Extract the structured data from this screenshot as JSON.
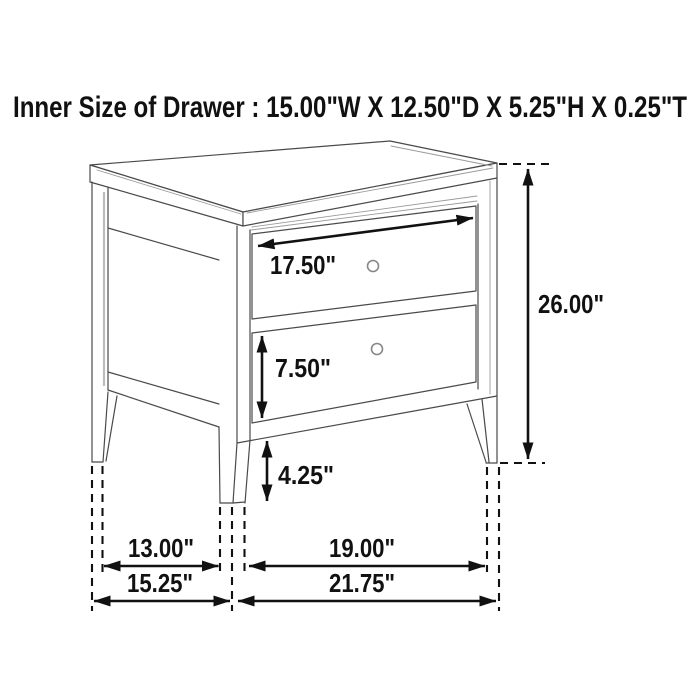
{
  "title": "Inner Size of Drawer : 15.00\"W X 12.50\"D X 5.25\"H X 0.25\"T",
  "figure": {
    "type": "furniture-dimension-diagram",
    "item": "two-drawer nightstand line drawing, three-quarter view",
    "drawer_count": 2,
    "knob_count": 2
  },
  "dimensions": {
    "drawer_front_width": "17.50\"",
    "overall_height": "26.00\"",
    "bottom_drawer_height": "7.50\"",
    "leg_height": "4.25\"",
    "side_legs_inner_span": "13.00\"",
    "front_legs_inner_span": "19.00\"",
    "overall_depth": "15.25\"",
    "overall_width": "21.75\""
  },
  "colors": {
    "background": "#ffffff",
    "furniture_line": "#4a4a4a",
    "furniture_trim": "#9a9a9a",
    "annotation": "#111111",
    "knob_stroke": "#878787"
  }
}
